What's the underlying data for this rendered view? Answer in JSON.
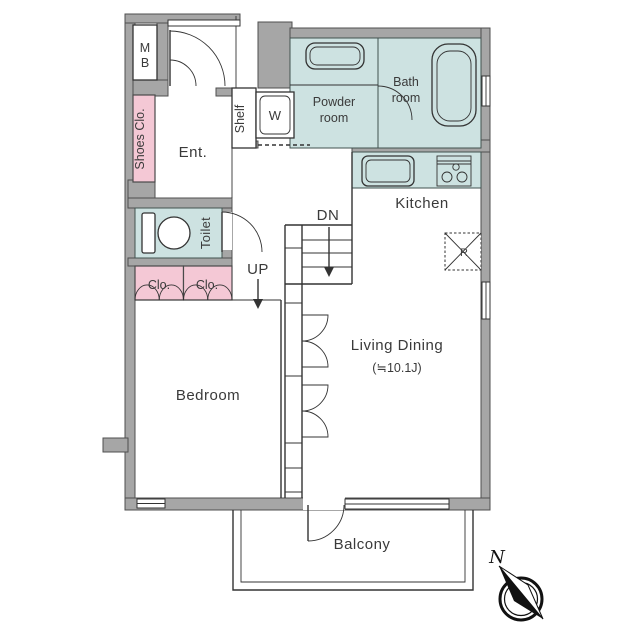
{
  "colors": {
    "wall": "#a6a6a6",
    "wall_stroke": "#4f4f4f",
    "teal": "#cde2e1",
    "pink": "#f4c8d5",
    "line": "#333333",
    "compass": "#111111"
  },
  "labels": {
    "mb_line1": "M",
    "mb_line2": "B",
    "shoes_closet": "Shoes Clo.",
    "entrance": "Ent.",
    "shelf": "Shelf",
    "washer": "W",
    "powder_line1": "Powder",
    "powder_line2": "room",
    "bath_line1": "Bath",
    "bath_line2": "room",
    "kitchen": "Kitchen",
    "toilet": "Toilet",
    "closet_left": "Clo.",
    "closet_right": "Clo.",
    "stairs_up": "UP",
    "stairs_down": "DN",
    "refrigerator": "R",
    "living_dining": "Living Dining",
    "living_dining_size": "(≒10.1J)",
    "bedroom": "Bedroom",
    "balcony": "Balcony",
    "compass_north": "N"
  }
}
